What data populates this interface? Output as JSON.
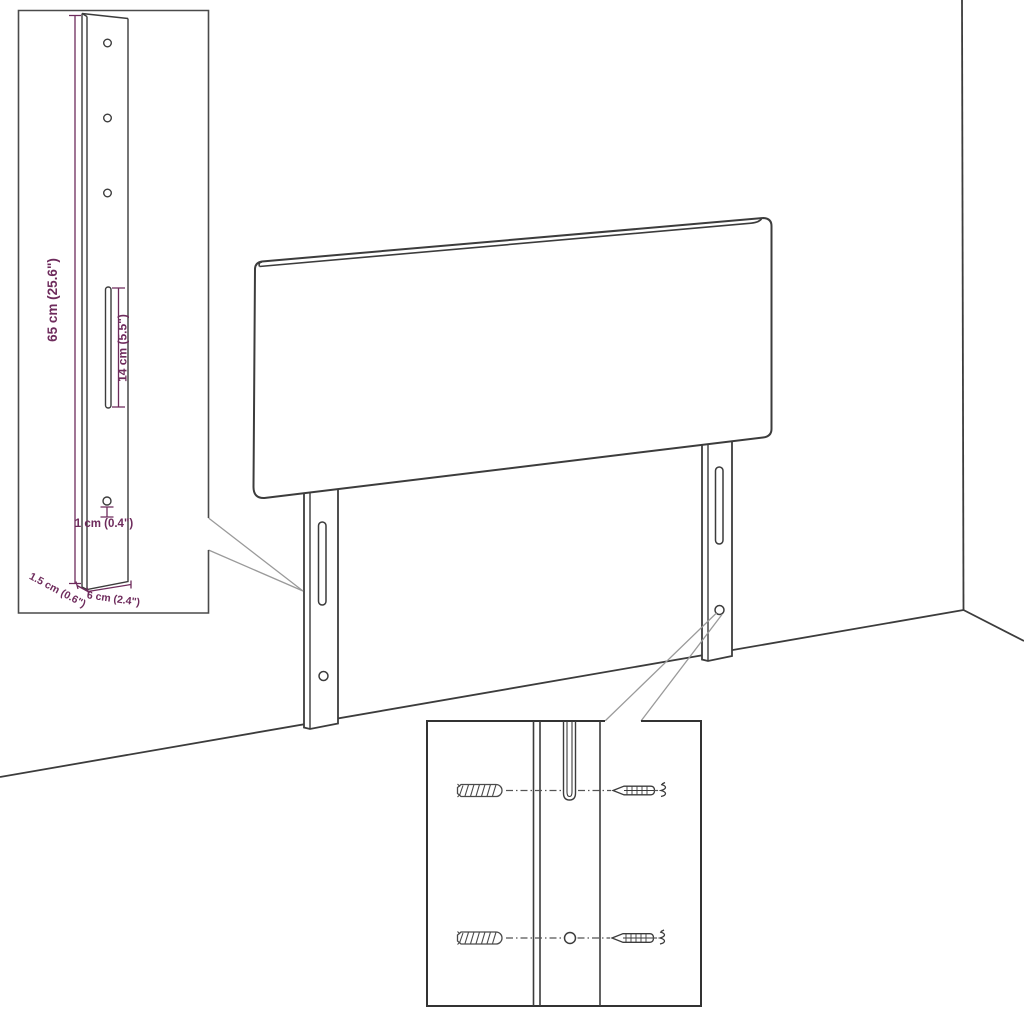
{
  "title": "Headboard with brackets assembly diagram",
  "diagram": {
    "style": "technical-line-art",
    "colors": {
      "background": "#ffffff",
      "line": "#3c3c3c",
      "callout": "#9a9a9a",
      "dimension": "#6e2b5c"
    },
    "bracket_detail_inset": {
      "holes_count": 3,
      "dimensions": {
        "height": "65 cm (25.6\")",
        "slot_length": "14 cm (5.5\")",
        "hole_diameter": "1 cm (0.4\")",
        "depth": "1.5 cm (0.6\")",
        "width": "6 cm (2.4\")"
      }
    },
    "hardware_detail_inset": {
      "rows": 2,
      "left_item": "wall-plug",
      "right_item": "screw"
    }
  }
}
